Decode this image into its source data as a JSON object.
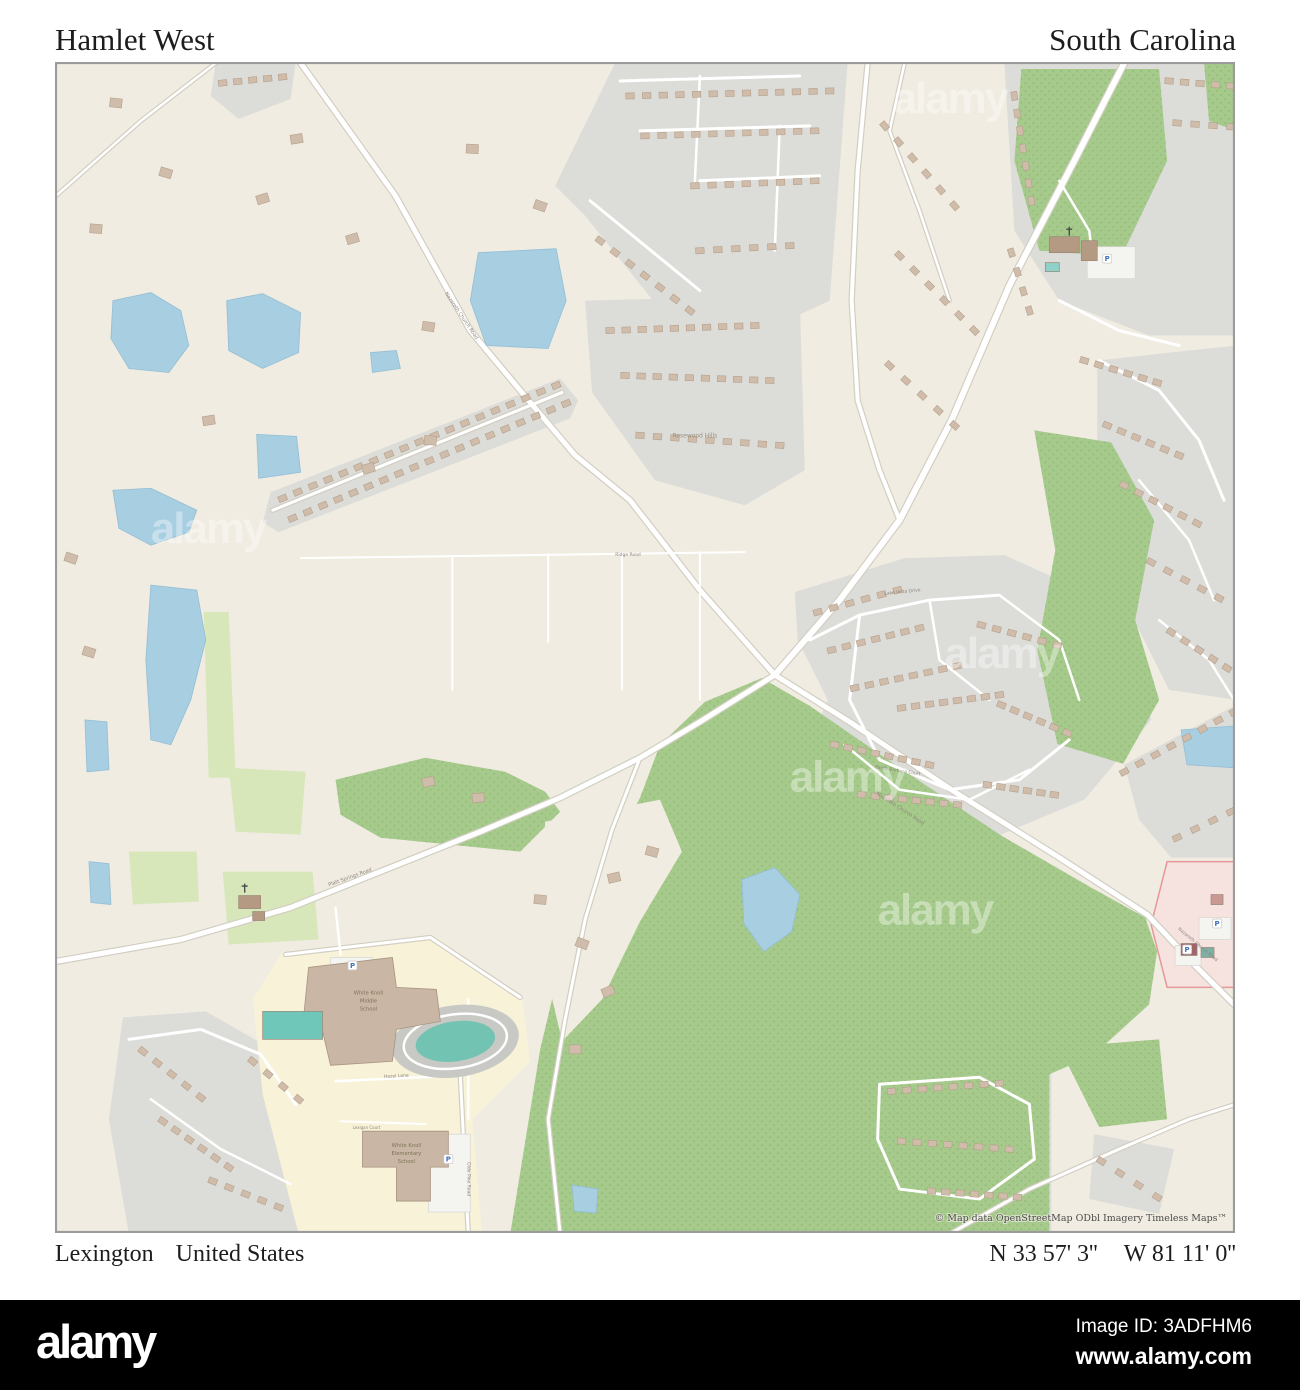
{
  "header": {
    "title_left": "Hamlet West",
    "title_right": "South Carolina"
  },
  "footer": {
    "place": "Lexington",
    "country": "United States",
    "latitude": "N 33 57' 3''",
    "longitude": "W 81 11' 0''"
  },
  "bottom_bar": {
    "logo": "alamy",
    "image_id": "Image ID: 3ADFHM6",
    "url": "www.alamy.com"
  },
  "map": {
    "attribution": "© Map data OpenStreetMap ODbl Imagery Timeless Maps™",
    "watermark_text": "alamy",
    "colors": {
      "bg": "#f0ece1",
      "gray": "#dcdcd9",
      "forest": "#a6ca8c",
      "dots": "#8fb873",
      "lightgreen": "#d8e7ba",
      "yellow": "#f7f2d8",
      "water": "#a7cee1",
      "waterline": "#93bed6",
      "pink": "#f6e2df",
      "pinkline": "#e59896",
      "roadCase": "#d2cec2",
      "road": "#ffffff",
      "bld": "#cfbcaa",
      "bldS": "#b5a08a",
      "track": "#72c3b1",
      "label": "#8e857a",
      "schoolLabel": "#7c7458",
      "attr": "#4b4b4b"
    },
    "regions": [
      {
        "c": "gray",
        "p": "215,62 295,62 290,98 238,118 210,95"
      },
      {
        "c": "gray",
        "p": "615,62 848,62 830,300 755,335 665,315 585,215 555,185"
      },
      {
        "c": "gray",
        "p": "585,300 800,295 805,470 745,505 655,480 592,392"
      },
      {
        "c": "gray",
        "p": "262,522 270,492 560,378 578,400 570,418 278,532"
      },
      {
        "c": "gray",
        "p": "1005,62 1237,62 1237,335 1150,335 1060,300 1015,230"
      },
      {
        "c": "gray",
        "p": "1098,360 1237,345 1237,700 1170,690 1125,600 1098,480"
      },
      {
        "c": "gray",
        "p": "795,592 905,558 1005,555 1072,585 1135,640 1152,720 1085,800 985,842 872,832 800,765 828,700 798,640"
      },
      {
        "c": "gray",
        "p": "868,1058 1052,1058 1052,1235 868,1235"
      },
      {
        "c": "gray",
        "p": "122,1018 205,1012 268,1048 305,1105 300,1180 310,1235 128,1235 108,1120"
      },
      {
        "c": "gray",
        "p": "1125,765 1237,705 1237,858 1172,858 1140,820"
      },
      {
        "c": "gray",
        "p": "1095,1135 1175,1150 1160,1215 1090,1200"
      },
      {
        "c": "forest",
        "p": "335,780 425,758 505,772 545,792 560,812 520,852 450,845 380,838 340,815"
      },
      {
        "c": "forest",
        "p": "660,745 705,702 762,678 810,706 900,768 1002,836 1092,888 1146,918 1158,952 1150,1005 1094,1056 1050,1075 1050,1235 510,1235 540,1050 565,945 605,865 640,798"
      },
      {
        "c": "forest",
        "p": "1035,430 1112,442 1155,520 1136,620 1160,700 1124,764 1058,744 1038,650 1056,550"
      },
      {
        "c": "forest",
        "p": "1022,68 1160,68 1168,160 1122,256 1040,250 1015,160"
      },
      {
        "c": "forest",
        "p": "1205,62 1237,62 1237,130 1210,120"
      },
      {
        "c": "forest",
        "p": "1060,1048 1160,1040 1168,1120 1100,1128"
      },
      {
        "c": "bg",
        "p": "545,822 660,800 682,852 640,922 602,1000 562,1042 538,940"
      },
      {
        "c": "lightgreen",
        "p": "203,612 228,612 235,778 208,778"
      },
      {
        "c": "lightgreen",
        "p": "222,872 312,872 318,940 228,945"
      },
      {
        "c": "lightgreen",
        "p": "128,852 196,852 198,902 132,905"
      },
      {
        "c": "lightgreen",
        "p": "228,768 305,772 300,835 235,832"
      },
      {
        "c": "yellow",
        "p": "282,952 432,935 522,998 530,1062 472,1120 482,1235 298,1235 262,1095 252,1000"
      },
      {
        "c": "pink",
        "p": "1168,862 1237,862 1237,988 1168,988 1152,925"
      }
    ],
    "roads": [
      {
        "d": "M300,62 L395,195 L470,330 L520,390 L575,455 L630,500 L700,590 L775,675",
        "w": 5,
        "k": 1
      },
      {
        "d": "M775,675 L850,722 L955,792 L1060,858 L1148,915 L1195,965 L1235,1005",
        "w": 5,
        "k": 1
      },
      {
        "d": "M775,675 L700,722 L640,758 L560,798 L480,832 L380,872 L290,908 L180,940 L55,962",
        "w": 5,
        "k": 1
      },
      {
        "d": "M1125,62 L1075,160 L1010,285 L952,420 L900,520 L840,600 L775,675",
        "w": 6,
        "k": 1
      },
      {
        "d": "M868,62 L858,170 L852,300 L858,400 L880,470 L900,520",
        "w": 4,
        "k": 1
      },
      {
        "d": "M300,558 L745,552",
        "w": 2,
        "k": 0
      },
      {
        "d": "M452,556 L452,690",
        "w": 2,
        "k": 0
      },
      {
        "d": "M548,554 L548,642",
        "w": 2,
        "k": 0
      },
      {
        "d": "M622,553 L622,690",
        "w": 2,
        "k": 0
      },
      {
        "d": "M700,552 L700,700",
        "w": 2,
        "k": 0
      },
      {
        "d": "M285,955 L430,938 L520,998",
        "w": 3,
        "k": 1
      },
      {
        "d": "M335,908 L340,955",
        "w": 2.5,
        "k": 0
      },
      {
        "d": "M468,1000 L468,1120",
        "w": 2.5,
        "k": 0
      },
      {
        "d": "M335,1082 L460,1076",
        "w": 2.5,
        "k": 0
      },
      {
        "d": "M340,1122 L425,1125",
        "w": 2,
        "k": 0
      },
      {
        "d": "M460,1076 L468,1235",
        "w": 3,
        "k": 1
      },
      {
        "d": "M640,758 L612,830 L585,920 L565,1020 L548,1120 L560,1235",
        "w": 3,
        "k": 1
      },
      {
        "d": "M950,1235 L1030,1190 L1120,1150 L1190,1120 L1237,1105",
        "w": 3,
        "k": 1
      },
      {
        "d": "M880,1085 L980,1078 L1030,1105 L1035,1160 L980,1200 L900,1190 L878,1140 L880,1085",
        "w": 3,
        "k": 0
      },
      {
        "d": "M1100,360 L1160,390 L1200,440 L1225,500",
        "w": 3,
        "k": 0
      },
      {
        "d": "M1140,480 L1190,540 L1215,600",
        "w": 2.5,
        "k": 0
      },
      {
        "d": "M1160,620 L1210,660 L1235,700",
        "w": 2.5,
        "k": 0
      },
      {
        "d": "M1060,300 L1120,330 L1180,345",
        "w": 3,
        "k": 0
      },
      {
        "d": "M810,640 L860,615 L930,600 L1000,595",
        "w": 3,
        "k": 0
      },
      {
        "d": "M860,615 L850,700 L880,760 L950,790 L1020,780 L1070,740",
        "w": 3,
        "k": 0
      },
      {
        "d": "M930,600 L940,660 L990,700",
        "w": 2.5,
        "k": 0
      },
      {
        "d": "M1000,595 L1060,640 L1080,700",
        "w": 2.5,
        "k": 0
      },
      {
        "d": "M845,745 L900,790 L970,800 L1030,770",
        "w": 2.5,
        "k": 0
      },
      {
        "d": "M620,80 L800,75",
        "w": 3,
        "k": 0
      },
      {
        "d": "M640,130 L810,125",
        "w": 3,
        "k": 0
      },
      {
        "d": "M590,200 L700,290",
        "w": 3,
        "k": 0
      },
      {
        "d": "M700,180 L820,175",
        "w": 3,
        "k": 0
      },
      {
        "d": "M700,75 L695,180",
        "w": 2.5,
        "k": 0
      },
      {
        "d": "M780,125 L775,250",
        "w": 2.5,
        "k": 0
      },
      {
        "d": "M272,510 L562,392",
        "w": 3,
        "k": 1
      },
      {
        "d": "M55,195 L140,120 L215,62",
        "w": 2.5,
        "k": 1
      },
      {
        "d": "M128,1040 L200,1030 L260,1055 L295,1105",
        "w": 3,
        "k": 0
      },
      {
        "d": "M150,1100 L220,1150 L290,1185",
        "w": 2.5,
        "k": 0
      },
      {
        "d": "M1060,180 L1090,230 L1095,270",
        "w": 2.5,
        "k": 0
      },
      {
        "d": "M905,62 L890,130 L920,210 L950,300",
        "w": 2.5,
        "k": 1
      }
    ],
    "lots": [
      [
        1088,
        246,
        48,
        32
      ],
      [
        428,
        1135,
        42,
        78
      ],
      [
        330,
        958,
        42,
        22
      ],
      [
        1200,
        918,
        32,
        22
      ],
      [
        1176,
        946,
        26,
        20
      ]
    ],
    "lakes": [
      "112,300 150,292 180,310 188,345 168,372 128,368 110,338",
      "226,300 262,293 300,312 298,352 262,368 228,350",
      "370,352 396,350 400,368 372,372",
      "478,252 556,248 566,300 548,348 486,345 470,300",
      "256,434 296,436 300,472 258,478",
      "112,490 150,488 196,510 188,532 150,545 118,528",
      "150,585 196,590 205,640 190,700 170,745 150,740 145,660",
      "84,720 106,722 108,770 86,772",
      "88,862 108,864 110,905 90,903",
      "742,880 775,868 800,895 792,932 764,952 744,924",
      "1182,730 1237,726 1237,768 1188,765",
      "572,1186 598,1190 596,1214 574,1212"
    ],
    "strips": [
      [
        222,
        82,
        282,
        76,
        5
      ],
      [
        630,
        95,
        830,
        90,
        13
      ],
      [
        645,
        135,
        815,
        130,
        11
      ],
      [
        695,
        185,
        815,
        180,
        8
      ],
      [
        600,
        240,
        690,
        310,
        7
      ],
      [
        700,
        250,
        790,
        245,
        6
      ],
      [
        610,
        330,
        755,
        325,
        10
      ],
      [
        625,
        375,
        770,
        380,
        10
      ],
      [
        640,
        435,
        780,
        445,
        9
      ],
      [
        282,
        498,
        556,
        385,
        19
      ],
      [
        292,
        518,
        566,
        403,
        19
      ],
      [
        885,
        125,
        955,
        205,
        6
      ],
      [
        900,
        255,
        975,
        330,
        6
      ],
      [
        890,
        365,
        955,
        425,
        5
      ],
      [
        1015,
        95,
        1032,
        200,
        7
      ],
      [
        1170,
        80,
        1232,
        85,
        5
      ],
      [
        1178,
        122,
        1232,
        126,
        4
      ],
      [
        1012,
        252,
        1030,
        310,
        4
      ],
      [
        1085,
        360,
        1158,
        382,
        6
      ],
      [
        1108,
        425,
        1180,
        455,
        6
      ],
      [
        1125,
        485,
        1198,
        523,
        6
      ],
      [
        1152,
        562,
        1220,
        598,
        5
      ],
      [
        1172,
        632,
        1228,
        668,
        5
      ],
      [
        818,
        612,
        898,
        590,
        6
      ],
      [
        832,
        650,
        920,
        628,
        7
      ],
      [
        855,
        688,
        958,
        666,
        8
      ],
      [
        835,
        745,
        930,
        765,
        8
      ],
      [
        862,
        795,
        958,
        805,
        8
      ],
      [
        902,
        708,
        1000,
        695,
        8
      ],
      [
        982,
        625,
        1058,
        645,
        6
      ],
      [
        1002,
        705,
        1068,
        733,
        6
      ],
      [
        988,
        785,
        1055,
        795,
        6
      ],
      [
        142,
        1052,
        200,
        1098,
        5
      ],
      [
        162,
        1122,
        228,
        1168,
        6
      ],
      [
        212,
        1182,
        278,
        1208,
        5
      ],
      [
        252,
        1062,
        298,
        1100,
        4
      ],
      [
        892,
        1092,
        1000,
        1084,
        8
      ],
      [
        902,
        1142,
        1010,
        1150,
        8
      ],
      [
        932,
        1192,
        1018,
        1198,
        7
      ],
      [
        1102,
        1162,
        1158,
        1198,
        4
      ],
      [
        1125,
        772,
        1235,
        712,
        8
      ],
      [
        1178,
        838,
        1232,
        812,
        4
      ]
    ],
    "singles": [
      [
        165,
        172
      ],
      [
        262,
        198
      ],
      [
        352,
        238
      ],
      [
        428,
        326
      ],
      [
        208,
        420
      ],
      [
        95,
        228
      ],
      [
        296,
        138
      ],
      [
        472,
        148
      ],
      [
        540,
        205
      ],
      [
        430,
        440
      ],
      [
        368,
        468
      ],
      [
        88,
        652
      ],
      [
        70,
        558
      ],
      [
        115,
        102
      ],
      [
        540,
        900
      ],
      [
        582,
        944
      ],
      [
        614,
        878
      ],
      [
        652,
        852
      ],
      [
        478,
        798
      ],
      [
        428,
        782
      ],
      [
        608,
        992
      ],
      [
        575,
        1050
      ]
    ],
    "special_buildings": [
      {
        "t": "poly",
        "p": "308,968 392,958 396,988 436,990 440,1022 396,1030 392,1062 330,1066 322,1032 302,1028",
        "f": "#c9b6a4"
      },
      {
        "t": "poly",
        "p": "362,1132 448,1132 448,1168 430,1168 430,1202 396,1202 396,1168 362,1168",
        "f": "#c9b6a4"
      },
      {
        "t": "rect",
        "r": [
          1050,
          236,
          30,
          16
        ],
        "f": "#b49a82"
      },
      {
        "t": "rect",
        "r": [
          1082,
          240,
          16,
          20
        ],
        "f": "#b49a82"
      },
      {
        "t": "rect",
        "r": [
          238,
          896,
          22,
          13
        ],
        "f": "#b49a82"
      },
      {
        "t": "rect",
        "r": [
          252,
          912,
          12,
          9
        ],
        "f": "#b49a82"
      },
      {
        "t": "rect",
        "r": [
          1182,
          944,
          16,
          12
        ],
        "f": "#a2646c"
      },
      {
        "t": "rect",
        "r": [
          1202,
          948,
          13,
          10
        ],
        "f": "#7fb0a6"
      },
      {
        "t": "rect",
        "r": [
          1212,
          895,
          12,
          10
        ],
        "f": "#c99a94"
      },
      {
        "t": "rect",
        "r": [
          262,
          1012,
          60,
          28
        ],
        "f": "#6fc7ba"
      },
      {
        "t": "rect",
        "r": [
          1046,
          262,
          14,
          9
        ],
        "f": "#8fd0c8"
      }
    ],
    "track": {
      "cx": 455,
      "cy": 1042,
      "rot": -8
    },
    "labels": [
      {
        "t": "Rosewood Hills",
        "x": 695,
        "y": 437,
        "s": 6,
        "c": "#99927f"
      },
      {
        "t": "Nazareth Church Road",
        "x": 460,
        "y": 316,
        "s": 5,
        "r": 56
      },
      {
        "t": "Nazareth Church Road",
        "x": 900,
        "y": 810,
        "s": 5,
        "r": 33
      },
      {
        "t": "Nazareth Church Road",
        "x": 1198,
        "y": 946,
        "s": 4.5,
        "r": 40
      },
      {
        "t": "Platt Springs Road",
        "x": 350,
        "y": 879,
        "s": 5,
        "r": -20
      },
      {
        "t": "Lake Vista Drive",
        "x": 903,
        "y": 593,
        "s": 4.5,
        "r": -6
      },
      {
        "t": "Santa Barbara Court",
        "x": 898,
        "y": 772,
        "s": 4.5,
        "r": 9
      },
      {
        "t": "Ridge Road",
        "x": 628,
        "y": 556,
        "s": 4.5
      },
      {
        "t": "Hazel Lane",
        "x": 396,
        "y": 1078,
        "s": 4.5,
        "r": -3
      },
      {
        "t": "Lexigan Court",
        "x": 366,
        "y": 1130,
        "s": 4
      },
      {
        "t": "Olde Pine Road",
        "x": 467,
        "y": 1180,
        "s": 4.5,
        "r": 90
      },
      {
        "t": "White Knoll",
        "x": 368,
        "y": 995,
        "s": 5.2,
        "sc": 1
      },
      {
        "t": "Middle",
        "x": 368,
        "y": 1003,
        "s": 5.2,
        "sc": 1
      },
      {
        "t": "School",
        "x": 368,
        "y": 1011,
        "s": 5.2,
        "sc": 1
      },
      {
        "t": "White Knoll",
        "x": 406,
        "y": 1148,
        "s": 5.2,
        "sc": 1
      },
      {
        "t": "Elementary",
        "x": 406,
        "y": 1156,
        "s": 5.2,
        "sc": 1
      },
      {
        "t": "School",
        "x": 406,
        "y": 1164,
        "s": 5.2,
        "sc": 1
      }
    ],
    "parking_icons": [
      [
        352,
        966
      ],
      [
        448,
        1160
      ],
      [
        1108,
        258
      ],
      [
        1218,
        924
      ],
      [
        1188,
        950
      ]
    ],
    "church_icons": [
      [
        1070,
        230
      ],
      [
        244,
        888
      ]
    ],
    "watermarks": [
      [
        150,
        543
      ],
      [
        878,
        925
      ],
      [
        945,
        668
      ],
      [
        893,
        112
      ],
      [
        790,
        792
      ]
    ],
    "attribution_pos": [
      1228,
      1222
    ]
  }
}
